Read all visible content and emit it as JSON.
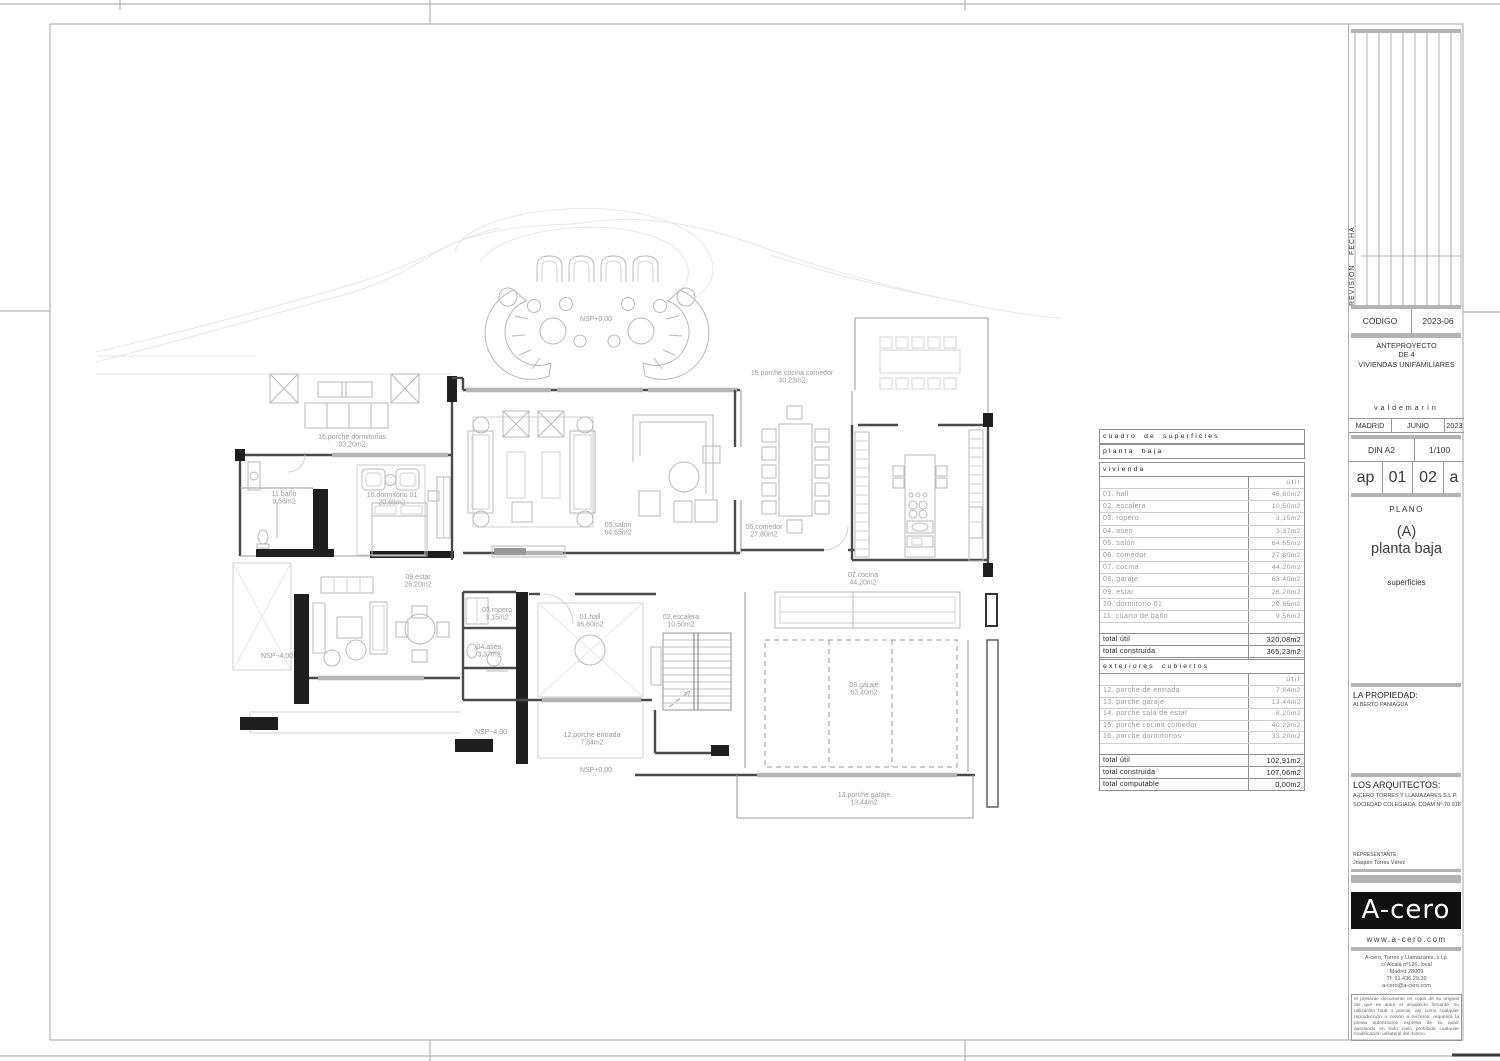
{
  "sheet": {
    "revision_label": "REVISION",
    "fecha_label": "FECHA",
    "code_label": "CÓDIGO",
    "code_value": "2023-06",
    "project": [
      "ANTEPROYECTO",
      "DE 4",
      "VIVIENDAS UNIFAMILIARES"
    ],
    "location": "valdemarín",
    "city": "MADRID",
    "month": "JUNIO",
    "year": "2023",
    "format": "DIN A2",
    "scale": "1/100",
    "codes": [
      "ap",
      "01",
      "02",
      "a"
    ],
    "plano_label": "PLANO",
    "plan_letter": "(A)",
    "plan_name": "planta baja",
    "plan_subtitle": "superficies",
    "property_label": "LA PROPIEDAD:",
    "property_name": "ALBERTO PANIAGUA",
    "architects_label": "LOS ARQUITECTOS:",
    "architects": [
      "A-CERO TORRES Y LLAMAZARES S.L.P.",
      "SOCIEDAD COLEGIADA. COAM Nº 70.918"
    ],
    "representative_label": "REPRESENTANTE:",
    "representative_name": "Joaquín Torres Vérez",
    "logo": "A-cero",
    "website": "www.a-cero.com",
    "address": [
      "A-cero, Torres y Llamazares, s.l.p.",
      "c/ Alcalá nº126, local",
      "Madrid 28009",
      "Tf: 91.436.29.39",
      "a-cero@a-cero.com"
    ],
    "disclaimer": "el presente documento es copia de su original del que es autor el arquitecto firmante, su utilización total o parcial, así como cualquier reproducción o cesión a terceros, requerirá la previa autorización expresa de su autor quedando en todo caso prohibida cualquier modificación unilateral del mismo."
  },
  "colors": {
    "bars": "#b3b3b3",
    "walls": "#4a4a4a",
    "furniture": "#b9b9b9",
    "labels": "#9a9a9a"
  },
  "tables": {
    "title1": "cuadro de superficies",
    "title2": "planta baja",
    "vivienda": {
      "header": "vivienda",
      "col": "útil",
      "rows": [
        [
          "01. hall",
          "46,60m2"
        ],
        [
          "02. escalera",
          "10,50m2"
        ],
        [
          "03. ropero",
          "3,15m2"
        ],
        [
          "04. aseo",
          "3,37m2"
        ],
        [
          "05. salón",
          "64,65m2"
        ],
        [
          "06. comedor",
          "27,80m2"
        ],
        [
          "07. cocina",
          "44,20m2"
        ],
        [
          "08. garaje",
          "63,40m2"
        ],
        [
          "09. estar",
          "26,20m2"
        ],
        [
          "10. dormitorio 01",
          "20,65m2"
        ],
        [
          "11. cuarto de baño",
          "9,56m2"
        ]
      ],
      "totals": [
        [
          "total útil",
          "320,08m2"
        ],
        [
          "total construida",
          "365,23m2"
        ],
        [
          "total computable",
          "365,23m2"
        ]
      ]
    },
    "exteriores": {
      "header": "exteriores cubiertos",
      "col": "útil",
      "rows": [
        [
          "12. porche de entrada",
          "7,84m2"
        ],
        [
          "13. porche garaje",
          "13,44m2"
        ],
        [
          "14. porche sala de estar",
          "8,20m2"
        ],
        [
          "15. porche cocina comedor",
          "40,23m2"
        ],
        [
          "16. porche dormitorios",
          "33,20m2"
        ]
      ],
      "totals": [
        [
          "total útil",
          "102,91m2"
        ],
        [
          "total construida",
          "107,06m2"
        ],
        [
          "total computable",
          "0,00m2"
        ]
      ]
    }
  },
  "plan_labels": [
    {
      "t": [
        "16.porche dormitorios",
        "33,20m2"
      ],
      "x": 352,
      "y": 439
    },
    {
      "t": [
        "NSP+0,00"
      ],
      "x": 596,
      "y": 321
    },
    {
      "t": [
        "15.porche cocina comedor",
        "40,23m2"
      ],
      "x": 792,
      "y": 375
    },
    {
      "t": [
        "11.baño",
        "9,56m2"
      ],
      "x": 284,
      "y": 496
    },
    {
      "t": [
        "10.dormitorio 01",
        "20,65m2"
      ],
      "x": 392,
      "y": 497
    },
    {
      "t": [
        "05.salón",
        "64,65m2"
      ],
      "x": 618,
      "y": 527
    },
    {
      "t": [
        "06.comedor",
        "27,80m2"
      ],
      "x": 764,
      "y": 529
    },
    {
      "t": [
        "07.cocina",
        "44,20m2"
      ],
      "x": 863,
      "y": 577
    },
    {
      "t": [
        "09.estar",
        "26,20m2"
      ],
      "x": 418,
      "y": 579
    },
    {
      "t": [
        "NSP−4,00"
      ],
      "x": 277,
      "y": 658
    },
    {
      "t": [
        "03.ropero",
        "3,15m2"
      ],
      "x": 497,
      "y": 612
    },
    {
      "t": [
        "04.aseo",
        "3,37m2"
      ],
      "x": 489,
      "y": 649
    },
    {
      "t": [
        "01.hall",
        "46,60m2"
      ],
      "x": 590,
      "y": 619
    },
    {
      "t": [
        "02.escalera",
        "10,50m2"
      ],
      "x": 681,
      "y": 619
    },
    {
      "t": [
        "08.garaje",
        "63,40m2"
      ],
      "x": 864,
      "y": 687
    },
    {
      "t": [
        "NSP−4,00"
      ],
      "x": 491,
      "y": 734
    },
    {
      "t": [
        "12.porche entrada",
        "7,84m2"
      ],
      "x": 592,
      "y": 737
    },
    {
      "t": [
        "NSP+0,00"
      ],
      "x": 596,
      "y": 772
    },
    {
      "t": [
        "13.porche garaje",
        "13,44m2"
      ],
      "x": 864,
      "y": 797
    }
  ]
}
